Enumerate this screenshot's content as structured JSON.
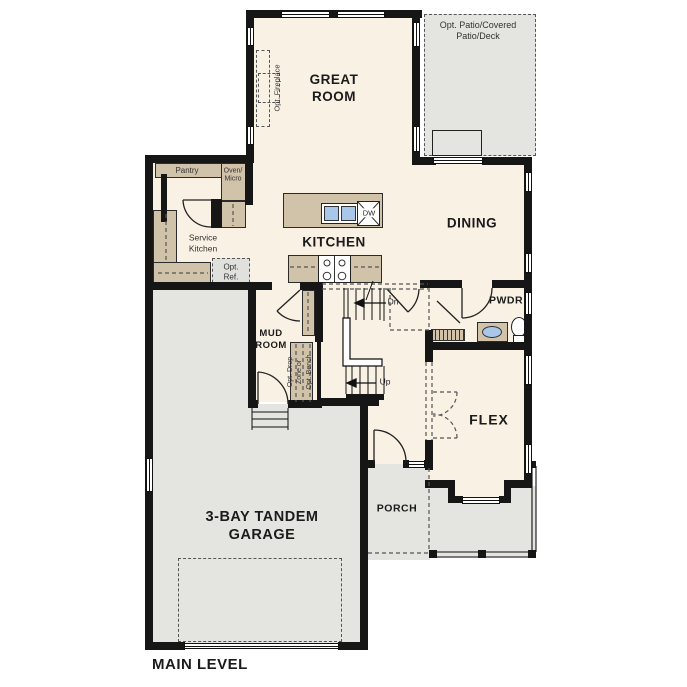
{
  "plan": {
    "title": "MAIN LEVEL",
    "colors": {
      "floor": "#f8f1e4",
      "outdoor": "#e4e4e1",
      "wall": "#161616",
      "cabinet": "#d1c2aa",
      "sink": "#a9c8e9",
      "ref_box": "#e0e0dd",
      "text": "#1b1b1b"
    },
    "rooms": {
      "great_room": [
        "GREAT",
        "ROOM"
      ],
      "patio": [
        "Opt. Patio/Covered",
        "Patio/Deck"
      ],
      "dining": "DINING",
      "kitchen": "KITCHEN",
      "pwdr": "PWDR",
      "mud_room": [
        "MUD",
        "ROOM"
      ],
      "flex": "FLEX",
      "porch": "PORCH",
      "garage": [
        "3-BAY TANDEM",
        "GARAGE"
      ]
    },
    "annotations": {
      "opt_fireplace": "Opt. Fireplace",
      "pantry": "Pantry",
      "oven_micro": [
        "Oven/",
        "Micro"
      ],
      "service_kitchen": [
        "Service",
        "Kitchen"
      ],
      "opt_ref": [
        "Opt.",
        "Ref."
      ],
      "dishwasher": "DW",
      "stairs_down": "Dn",
      "stairs_up": "Up",
      "drop_zone": [
        "Opt. Drop",
        "Zone or",
        "Opt. Bench"
      ]
    }
  }
}
